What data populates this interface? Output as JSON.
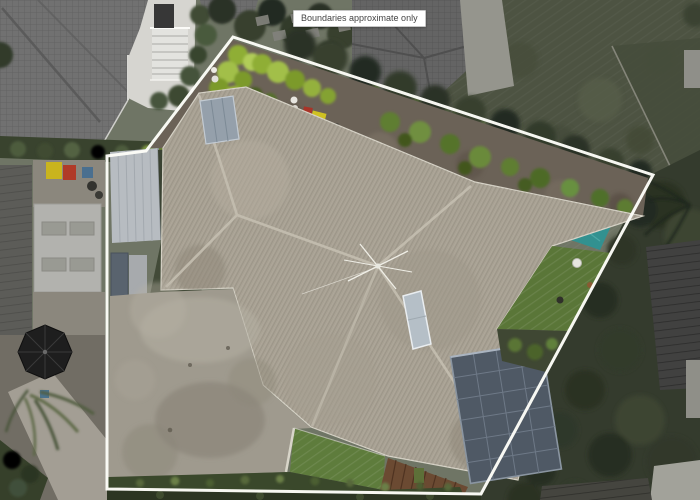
{
  "overlay": {
    "boundary_note": "Boundaries approximate only"
  },
  "scene": {
    "description": "Aerial drone photograph of a residential property, looking straight down, with white approximate boundary lines overlaid on the section",
    "palette": {
      "boundary_line": "#ffffff",
      "main_roof_tiles": "#a8a193",
      "roof_ridge": "#c3bdaf",
      "driveway_concrete": "#9f9a8e",
      "front_lawn": "#5e7c3c",
      "neighbour_lawn": "#4d5342",
      "trees": "#323a2b",
      "shade_sail": "#2e9292",
      "solar_panels": "#4f5965",
      "carport_roof": "#b7bcc1",
      "wooden_fence": "#6b4a32",
      "lime_hedge": "#9cb83a",
      "neighbour_roof": "#6e6e6e",
      "deck": "#d6d5d0",
      "umbrella": "#1e1e1e"
    },
    "features": [
      "main-house-roof",
      "skylight",
      "solar-panels",
      "tv-antenna",
      "carport",
      "driveway",
      "clothesline",
      "shade-sail",
      "lawn-strips",
      "ivy-hedge",
      "wooden-fence",
      "neighbour-roofs",
      "deck-stairs",
      "patio-umbrella",
      "boundary-overlay"
    ]
  }
}
